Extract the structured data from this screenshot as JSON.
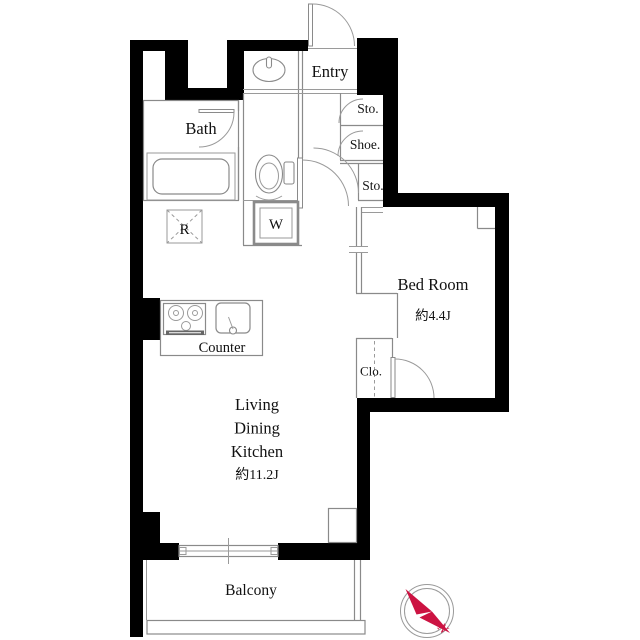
{
  "plan": {
    "labels": {
      "entry": "Entry",
      "bath": "Bath",
      "storage_top": "Sto.",
      "shoe": "Shoe.",
      "storage_mid": "Sto.",
      "refrigerator": "R",
      "washer": "W",
      "counter": "Counter",
      "bedroom_name": "Bed Room",
      "bedroom_size": "約4.4J",
      "closet": "Clo.",
      "ldk_line1": "Living",
      "ldk_line2": "Dining",
      "ldk_line3": "Kitchen",
      "ldk_size": "約11.2J",
      "balcony": "Balcony",
      "compass_north": "N"
    },
    "colors": {
      "wall": "#000000",
      "line": "#8a8a8a",
      "text": "#111111",
      "compass_red": "#cc1342"
    }
  }
}
